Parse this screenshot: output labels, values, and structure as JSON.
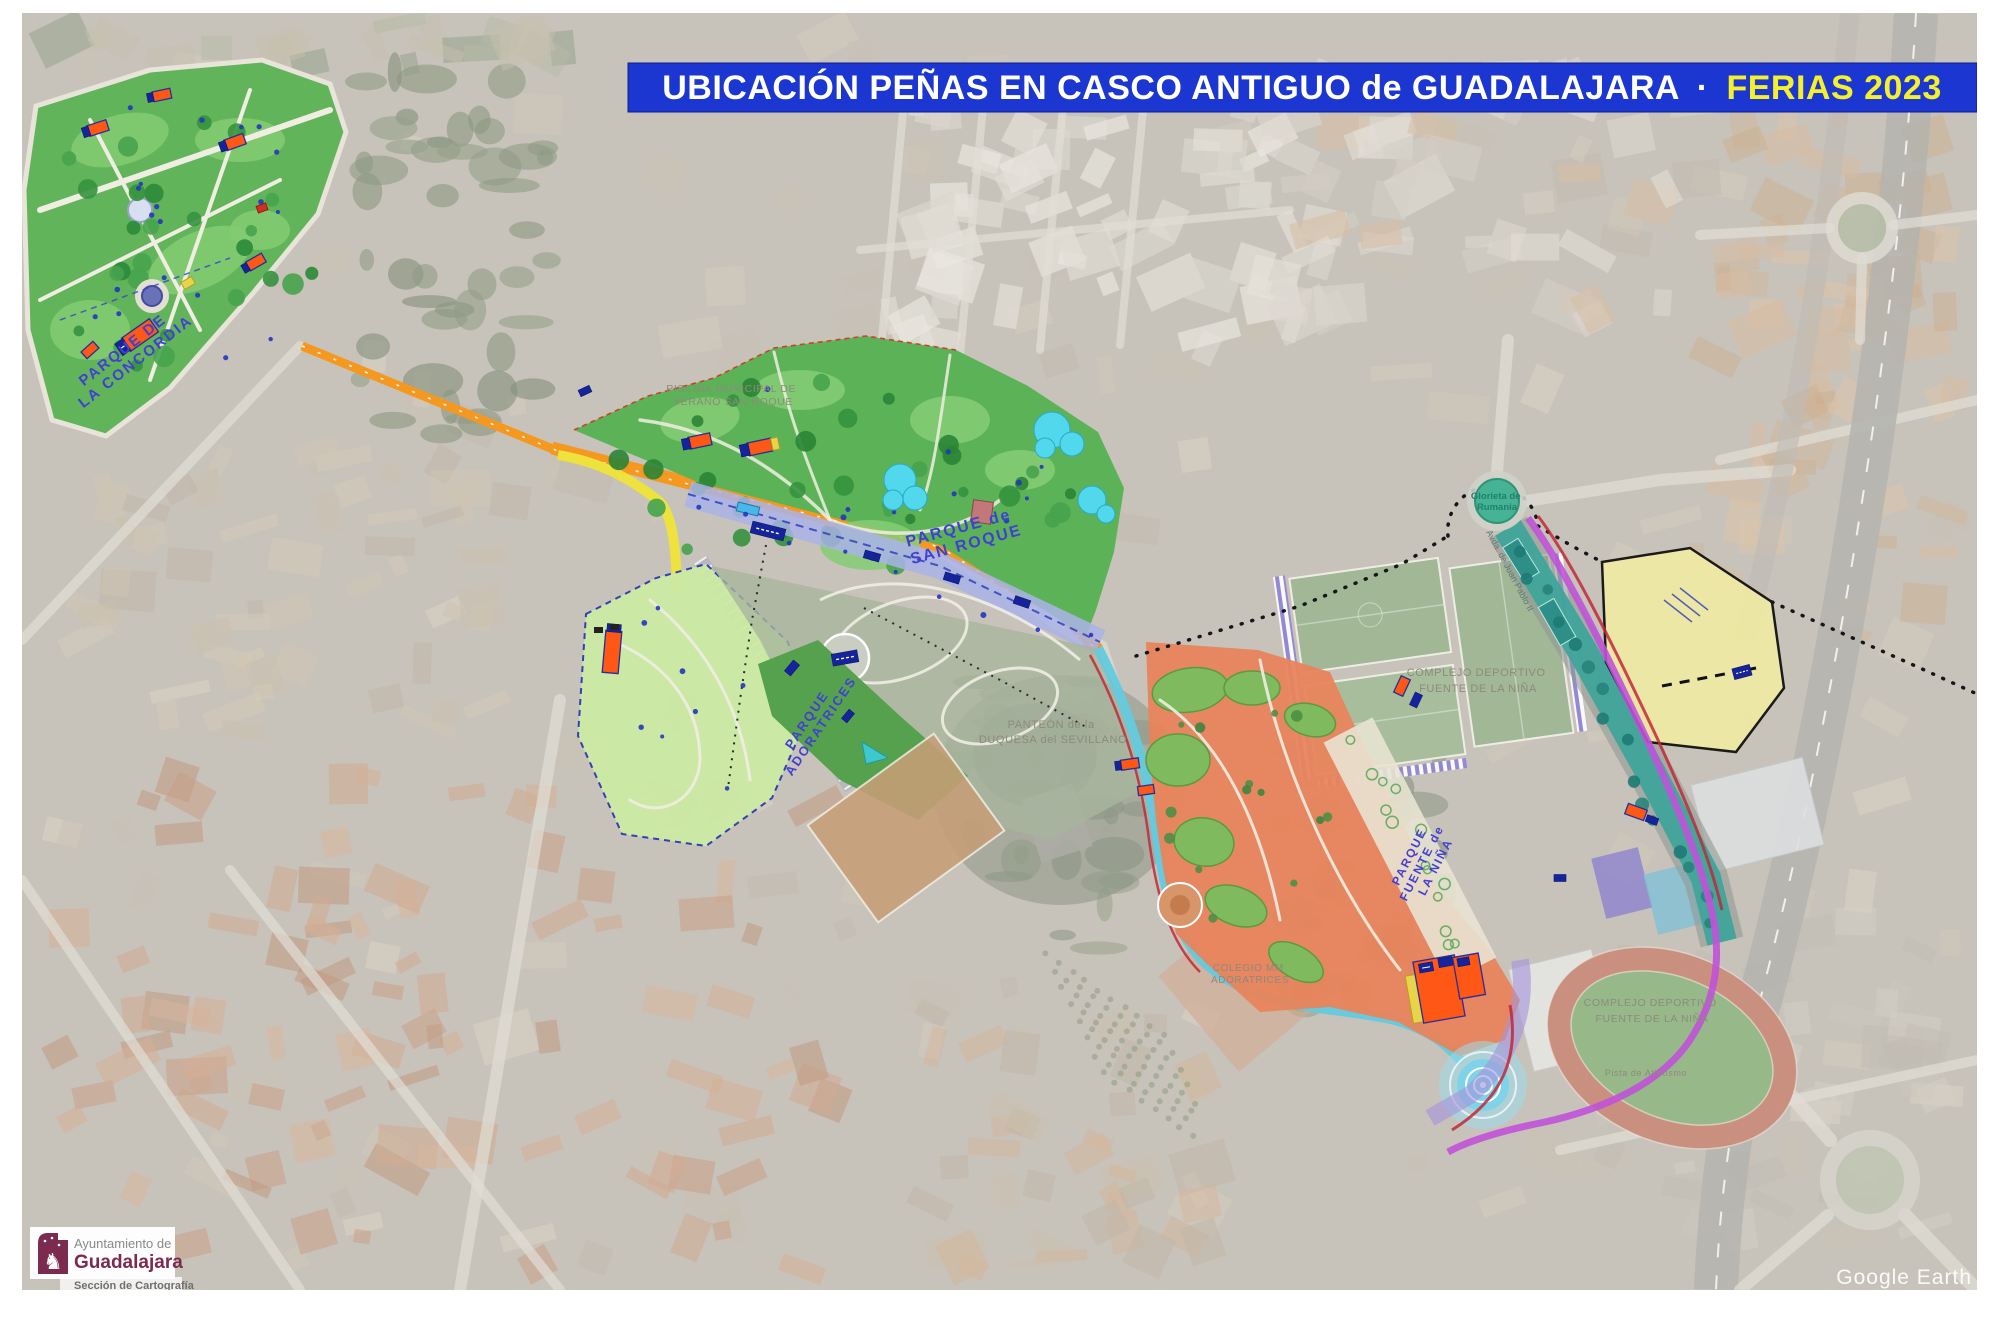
{
  "title": {
    "main": "UBICACIÓN PEÑAS EN CASCO ANTIGUO de GUADALAJARA",
    "separator": "·",
    "highlight": "FERIAS 2023"
  },
  "labels": {
    "concordia": [
      "PARQUE DE",
      "LA CONCORDIA"
    ],
    "san_roque": [
      "PARQUE de",
      "SAN ROQUE"
    ],
    "adoratrices": [
      "PARQUE",
      "ADORATRICES"
    ],
    "fuente_nina": [
      "PARQUE",
      "FUENTE de",
      "LA NIÑA"
    ],
    "panteon": [
      "PANTEÓN de la",
      "DUQUESA del SEVILLANO"
    ],
    "piscina": [
      "PISCINA MUNICIPAL DE",
      "VERANO SAN ROQUE"
    ],
    "complejo_norte": [
      "COMPLEJO DEPORTIVO",
      "FUENTE DE LA NIÑA"
    ],
    "complejo_sur": [
      "COMPLEJO DEPORTIVO",
      "FUENTE DE LA NIÑA"
    ],
    "colegio": [
      "COLEGIO MM",
      "ADORATRICES"
    ],
    "pista_atletismo": "Pista de Atletismo",
    "glorieta": [
      "Glorieta de",
      "Rumania"
    ],
    "avenida": "Avda. de Juan Pablo II"
  },
  "logo": {
    "line1": "Ayuntamiento de",
    "line2": "Guadalajara",
    "line3": "Sección de Cartografía"
  },
  "watermark": "Google Earth",
  "colors": {
    "banner_blue": "#1B36D1",
    "banner_yellow": "#F5F02C",
    "park_label_purple": "#4240D2",
    "facility_label_gray": "#8D8A7C",
    "pena_orange": "#FF5716",
    "pena_navy": "#16249B",
    "park_green": "#5CB357",
    "light_park_green": "#CDEAA4",
    "fuente_nina_orange": "#E8845C",
    "promenade_lavender": "#AAB3E8",
    "route_orange": "#F5981F",
    "route_yellow": "#EDE23E",
    "route_cyan": "#63CADD",
    "route_magenta": "#C052D8",
    "route_red": "#C22838",
    "pool_teal": "#3FA49B",
    "fairground_yellow": "#EFE9A4",
    "glorieta_teal": "#46B394",
    "logo_purple": "#7B2A50"
  }
}
